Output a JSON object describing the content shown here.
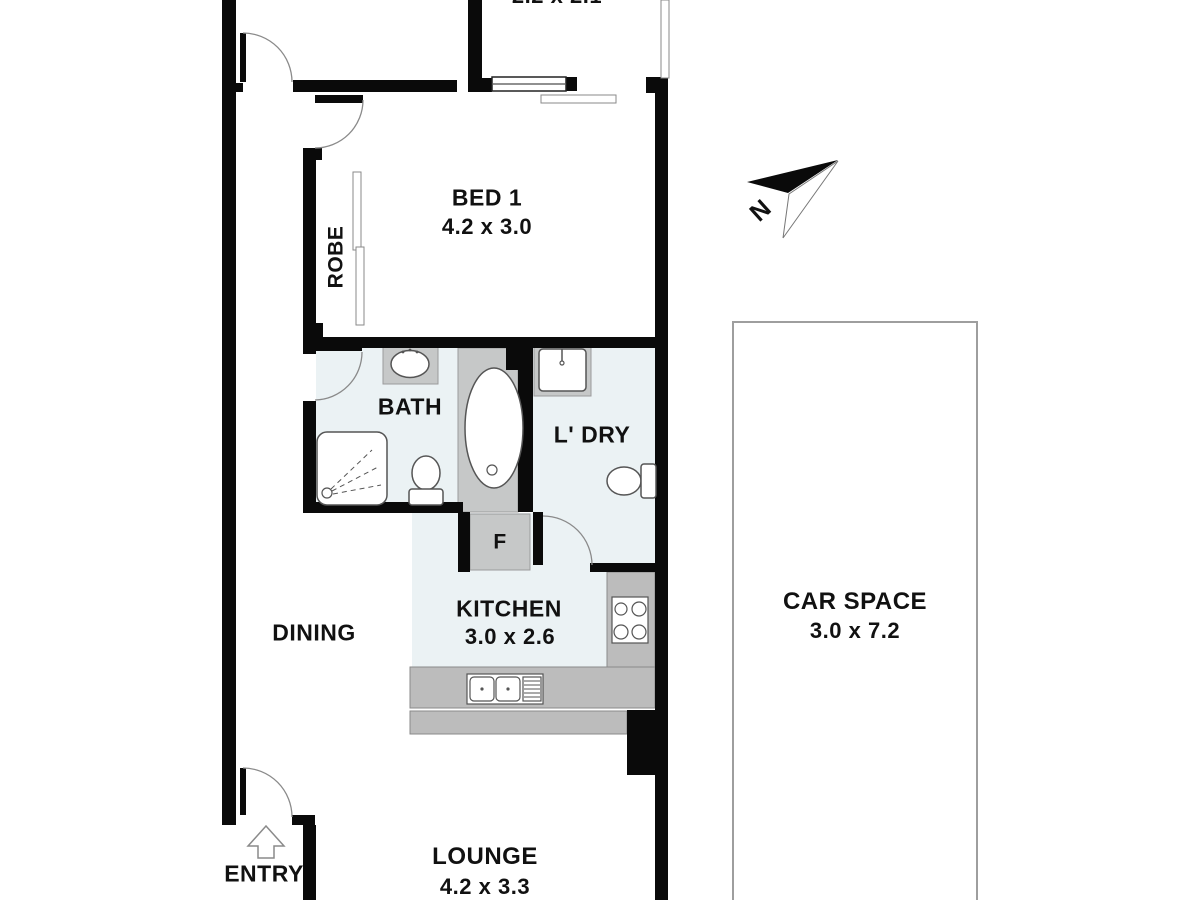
{
  "plan": {
    "balcony": {
      "dim": "2.2 x 2.1"
    },
    "bed1": {
      "name": "BED 1",
      "dim": "4.2 x 3.0"
    },
    "robe": {
      "name": "ROBE"
    },
    "bath": {
      "name": "BATH"
    },
    "laundry": {
      "name": "L' DRY"
    },
    "fridge": {
      "name": "F"
    },
    "kitchen": {
      "name": "KITCHEN",
      "dim": "3.0 x 2.6"
    },
    "dining": {
      "name": "DINING"
    },
    "lounge": {
      "name": "LOUNGE",
      "dim": "4.2 x 3.3"
    },
    "entry": {
      "name": "ENTRY"
    },
    "car_space": {
      "name": "CAR SPACE",
      "dim": "3.0 x 7.2"
    },
    "compass": {
      "north": "N"
    }
  },
  "colors": {
    "wall": "#0a0a0a",
    "wet_floor": "#ebf2f4",
    "fixture_fill": "#c6c8c8",
    "fixture_stroke": "#9b9b9b",
    "counter": "#bcbcbc",
    "counter_stroke": "#8a8a8a",
    "fixture_line": "#555555",
    "arc_line": "#8a8a8a",
    "car_border": "#9e9e9e",
    "text": "#111111"
  }
}
